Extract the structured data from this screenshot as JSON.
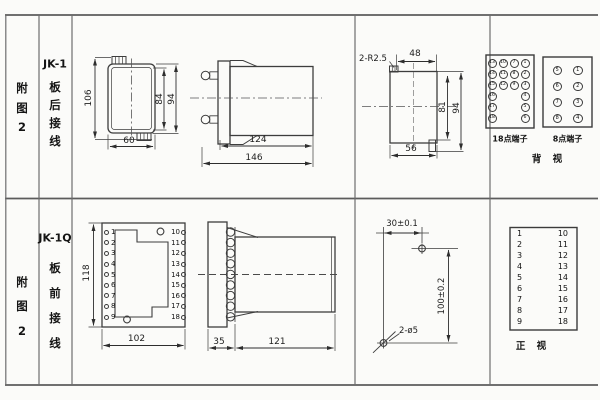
{
  "left_top": {
    "fig": [
      "附",
      "图",
      "2"
    ],
    "model": "JK-1",
    "wiring": [
      "板",
      "后",
      "接",
      "线"
    ]
  },
  "left_bottom": {
    "fig": [
      "附",
      "图",
      "2"
    ],
    "model": "JK-1Q",
    "wiring": [
      "板",
      "前",
      "接",
      "线"
    ]
  },
  "rear_view": {
    "dim_overall_height": "106",
    "dim_inner_height": "84",
    "dim_outer_height": "94",
    "dim_width": "60"
  },
  "side_view_top": {
    "dim_body": "124",
    "dim_overall": "146"
  },
  "cutout_rear": {
    "corner_label": "2-R2.5",
    "dim_top": "48",
    "dim_inner": "81",
    "dim_outer": "94",
    "dim_bottom": "56"
  },
  "terminals_back": {
    "block18": {
      "label": "18点端子",
      "col1": [
        "13",
        "14",
        "15",
        "16",
        "17",
        "18"
      ],
      "col2": [
        "10",
        "11",
        "12"
      ],
      "col3": [
        "7",
        "8",
        "9"
      ],
      "col4": [
        "1",
        "2",
        "3",
        "4",
        "5",
        "6"
      ]
    },
    "block8": {
      "label": "8点端子",
      "left": [
        "5",
        "6",
        "7",
        "8"
      ],
      "right": [
        "1",
        "2",
        "3",
        "4"
      ]
    },
    "view_label": "背 视"
  },
  "front_view": {
    "dim_height": "118",
    "dim_width": "102",
    "left": [
      "1",
      "2",
      "3",
      "4",
      "5",
      "6",
      "7",
      "8",
      "9"
    ],
    "right": [
      "10",
      "11",
      "12",
      "13",
      "14",
      "15",
      "16",
      "17",
      "18"
    ]
  },
  "side_view_bottom": {
    "dim_front": "35",
    "dim_body": "121"
  },
  "drill_plan": {
    "dim_h": "30±0.1",
    "dim_v": "100±0.2",
    "hole_label": "2-ø5"
  },
  "terminals_front": {
    "left": [
      "1",
      "2",
      "3",
      "4",
      "5",
      "6",
      "7",
      "8",
      "9"
    ],
    "right": [
      "10",
      "11",
      "12",
      "13",
      "14",
      "15",
      "16",
      "17",
      "18"
    ],
    "view_label": "正 视"
  }
}
